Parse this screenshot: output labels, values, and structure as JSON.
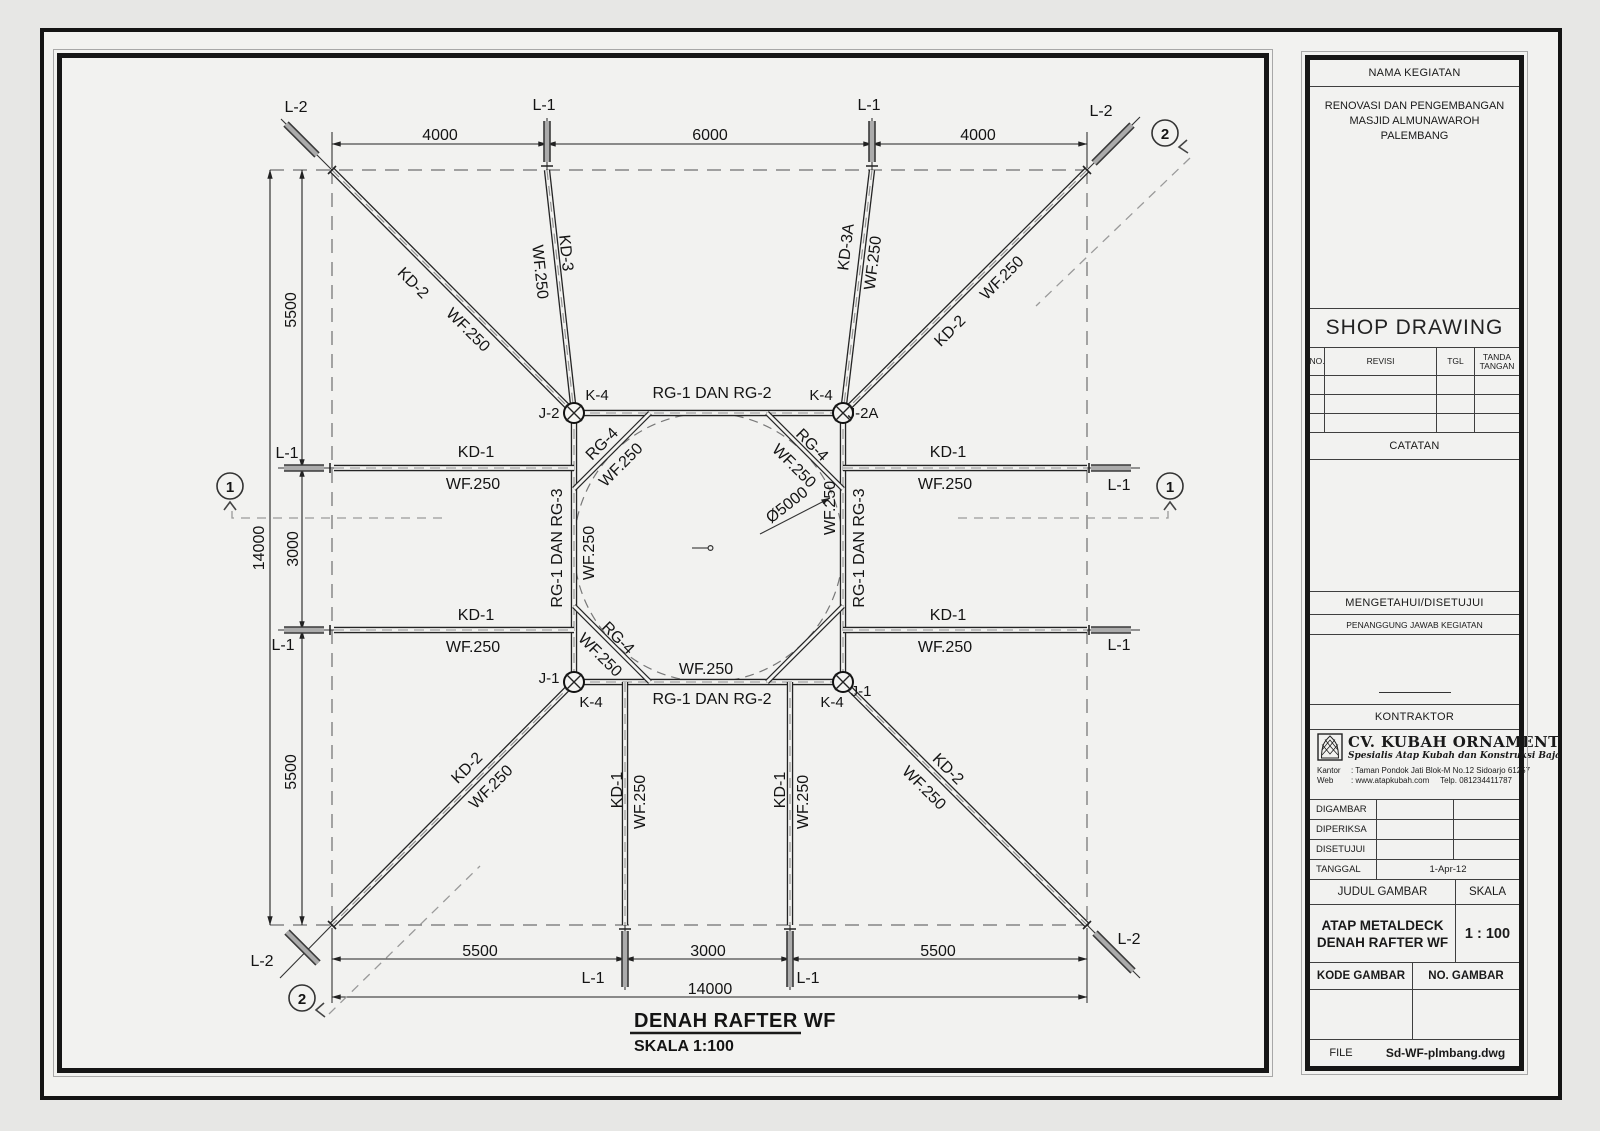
{
  "title_block": {
    "nama_kegiatan": "NAMA KEGIATAN",
    "project_lines": [
      "RENOVASI DAN PENGEMBANGAN",
      "MASJID ALMUNAWAROH",
      "PALEMBANG"
    ],
    "shop_drawing": "SHOP DRAWING",
    "revision_table": {
      "no": "NO.",
      "revisi": "REVISI",
      "tgl": "TGL",
      "tanda_line1": "TANDA",
      "tanda_line2": "TANGAN"
    },
    "catatan": "CATATAN",
    "mengetahui": "MENGETAHUI/DISETUJUI",
    "penanggung_jawab": "PENANGGUNG JAWAB KEGIATAN",
    "kontraktor": "KONTRAKTOR",
    "company": {
      "name": "CV. KUBAH ORNAMENT",
      "tagline": "Spesialis Atap Kubah dan Konstruksi Baja",
      "kantor_label": "Kantor",
      "kantor_value": ": Taman Pondok Jati Blok-M No.12 Sidoarjo 61257",
      "web_label": "Web",
      "web_value": ": www.atapkubah.com",
      "telp": "Telp. 081234411787"
    },
    "sign_rows": {
      "digambar": "DIGAMBAR",
      "diperiksa": "DIPERIKSA",
      "disetujui": "DISETUJUI",
      "tanggal": "TANGGAL",
      "tanggal_value": "1-Apr-12"
    },
    "judul_gambar": "JUDUL GAMBAR",
    "skala": "SKALA",
    "drawing_title_line1": "ATAP METALDECK",
    "drawing_title_line2": "DENAH RAFTER WF",
    "scale_value": "1 : 100",
    "kode_gambar": "KODE GAMBAR",
    "no_gambar": "NO. GAMBAR",
    "file_label": "FILE",
    "file_value": "Sd-WF-plmbang.dwg"
  },
  "drawing": {
    "title": "DENAH RAFTER WF",
    "scale_note": "SKALA 1:100",
    "labels": {
      "l1": "L-1",
      "l2": "L-2",
      "kd1": "KD-1",
      "kd2": "KD-2",
      "kd3": "KD-3",
      "kd3a": "KD-3A",
      "wf250": "WF.250",
      "rg12": "RG-1 DAN RG-2",
      "rg13": "RG-1 DAN RG-3",
      "rg4": "RG-4",
      "k4": "K-4",
      "j1": "J-1",
      "j2": "J-2",
      "j2a": "J-2A",
      "diameter": "Ø5000"
    },
    "dims": {
      "top_left": "4000",
      "top_mid": "6000",
      "top_right": "4000",
      "left_top": "5500",
      "left_mid": "3000",
      "left_bottom": "5500",
      "left_total": "14000",
      "bottom_left": "5500",
      "bottom_mid": "3000",
      "bottom_right": "5500",
      "bottom_total": "14000"
    },
    "sections": {
      "s1": "1",
      "s2": "2"
    }
  }
}
